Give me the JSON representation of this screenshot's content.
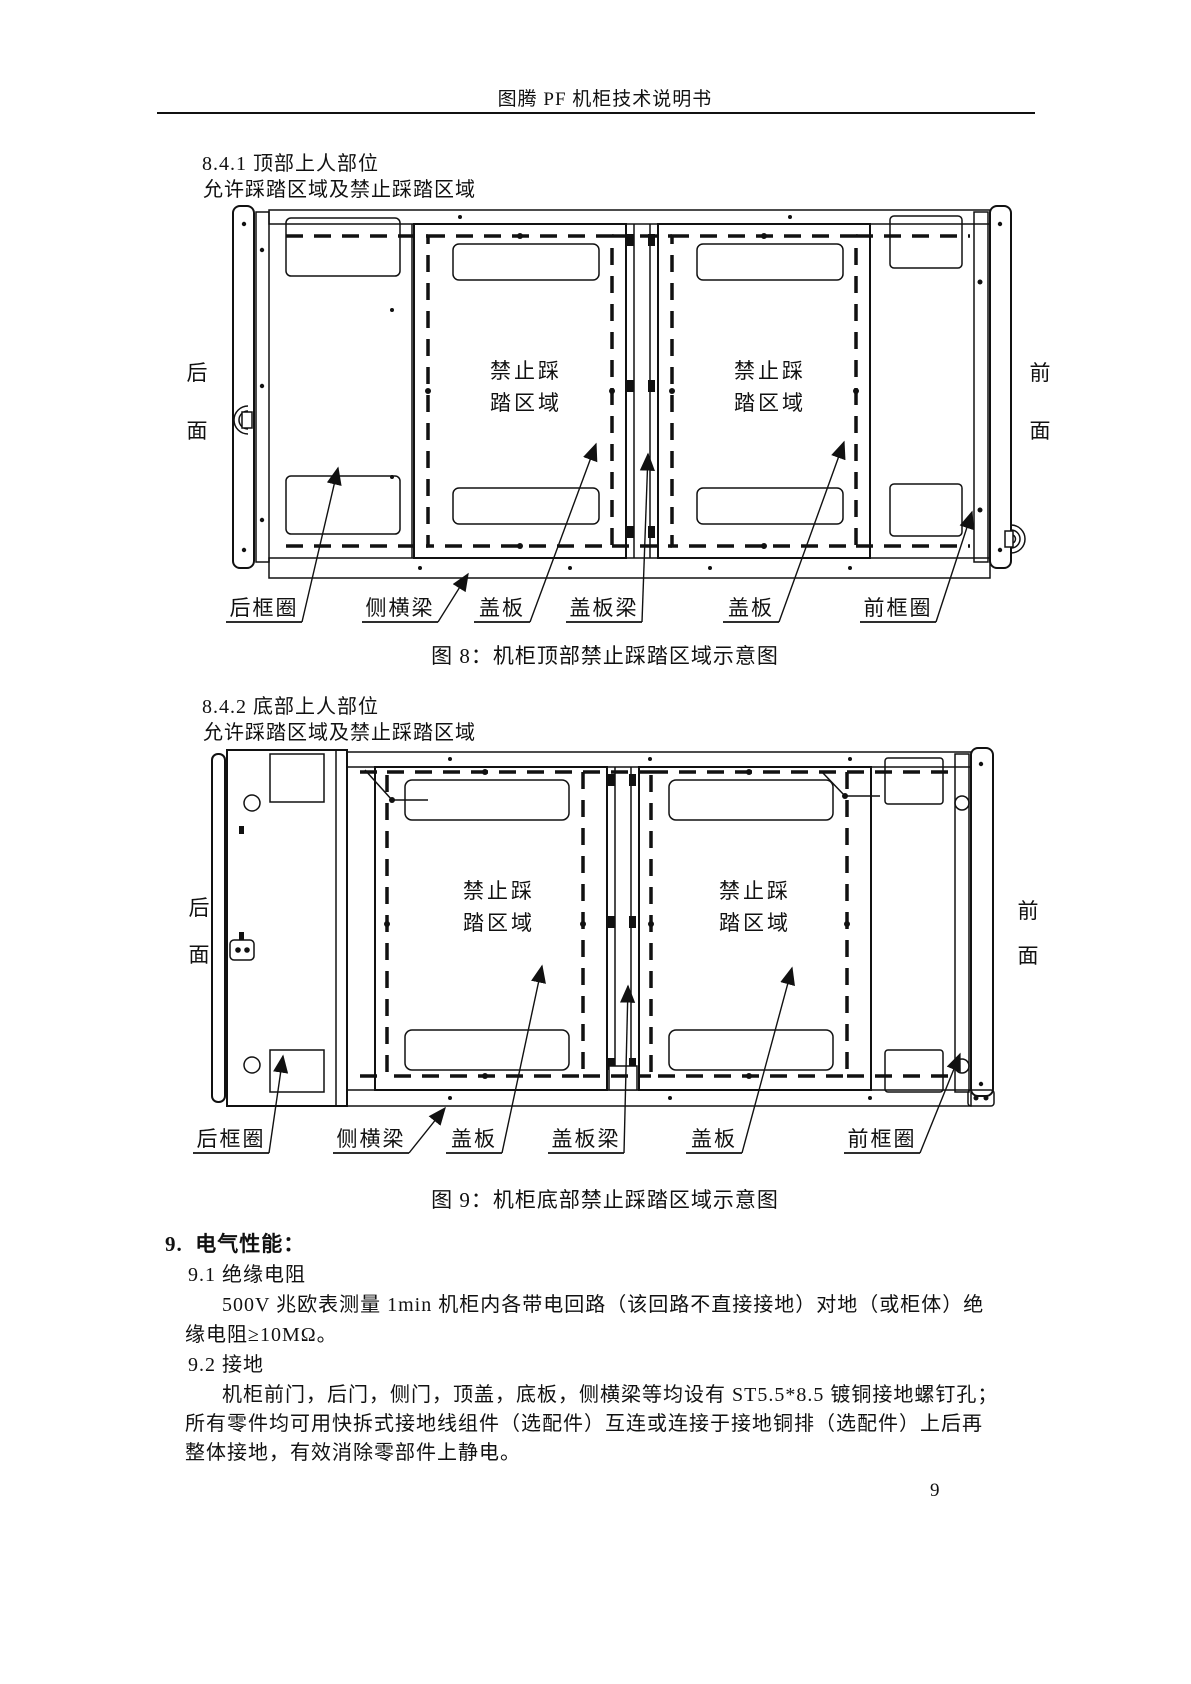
{
  "page": {
    "title": "图腾 PF 机柜技术说明书",
    "page_number": "9"
  },
  "section_841": {
    "heading": "8.4.1 顶部上人部位",
    "subheading": "允许踩踏区域及禁止踩踏区域"
  },
  "section_842": {
    "heading": "8.4.2 底部上人部位",
    "subheading": "允许踩踏区域及禁止踩踏区域"
  },
  "diagram_common": {
    "rear_top": "后",
    "rear_bottom": "面",
    "front_top": "前",
    "front_bottom": "面",
    "forbidden_line1": "禁止踩",
    "forbidden_line2": "踏区域"
  },
  "figure8": {
    "caption": "图 8：机柜顶部禁止踩踏区域示意图",
    "labels": [
      "后框圈",
      "侧横梁",
      "盖板",
      "盖板梁",
      "盖板",
      "前框圈"
    ]
  },
  "figure9": {
    "caption": "图 9：机柜底部禁止踩踏区域示意图",
    "labels": [
      "后框圈",
      "侧横梁",
      "盖板",
      "盖板梁",
      "盖板",
      "前框圈"
    ]
  },
  "section_9": {
    "heading": "9.  电气性能：",
    "sub_91": "9.1 绝缘电阻",
    "p91_line1": "500V 兆欧表测量 1min 机柜内各带电回路（该回路不直接接地）对地（或柜体）绝",
    "p91_line2": "缘电阻≥10MΩ。",
    "sub_92": "9.2 接地",
    "p92_line1": "机柜前门，后门，侧门，顶盖，底板，侧横梁等均设有 ST5.5*8.5 镀铜接地螺钉孔；",
    "p92_line2": "所有零件均可用快拆式接地线组件（选配件）互连或连接于接地铜排（选配件）上后再",
    "p92_line3": "整体接地，有效消除零部件上静电。"
  }
}
